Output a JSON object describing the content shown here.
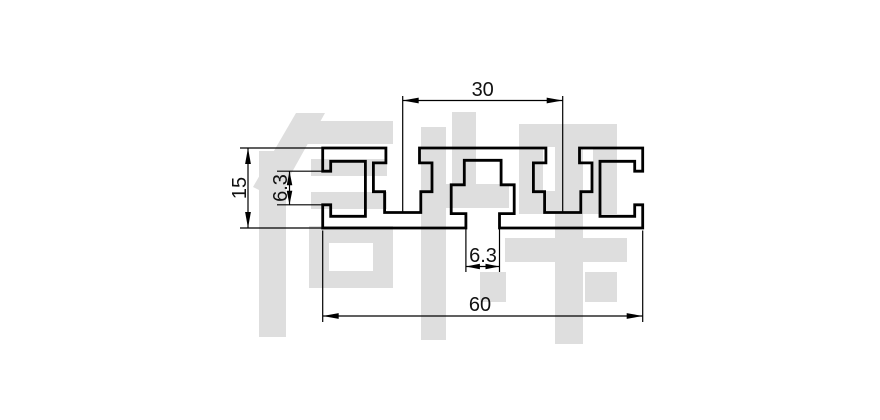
{
  "page": {
    "background": "#ffffff",
    "line_color": "#000000"
  },
  "watermark": {
    "text": "信牌",
    "color": "#dedede"
  },
  "drawing": {
    "type": "technical-drawing",
    "subject": "aluminum extrusion profile cross-section 15x60 with T-slots",
    "units": "mm",
    "profile": {
      "overall_width": 60,
      "overall_height": 15,
      "top_slot_spacing": 30,
      "slot_opening": 6.3,
      "top_slot_count": 2,
      "bottom_slot_count": 1,
      "end_slot_count": 2
    },
    "dimensions": [
      {
        "id": "top_slot_spacing",
        "value": "30",
        "orientation": "horizontal",
        "location": "top"
      },
      {
        "id": "profile_height",
        "value": "15",
        "orientation": "vertical",
        "location": "left"
      },
      {
        "id": "end_slot_opening",
        "value": "6.3",
        "orientation": "vertical",
        "location": "left"
      },
      {
        "id": "bottom_slot_opening",
        "value": "6.3",
        "orientation": "horizontal",
        "location": "bottom"
      },
      {
        "id": "profile_width",
        "value": "60",
        "orientation": "horizontal",
        "location": "bottom"
      }
    ]
  }
}
